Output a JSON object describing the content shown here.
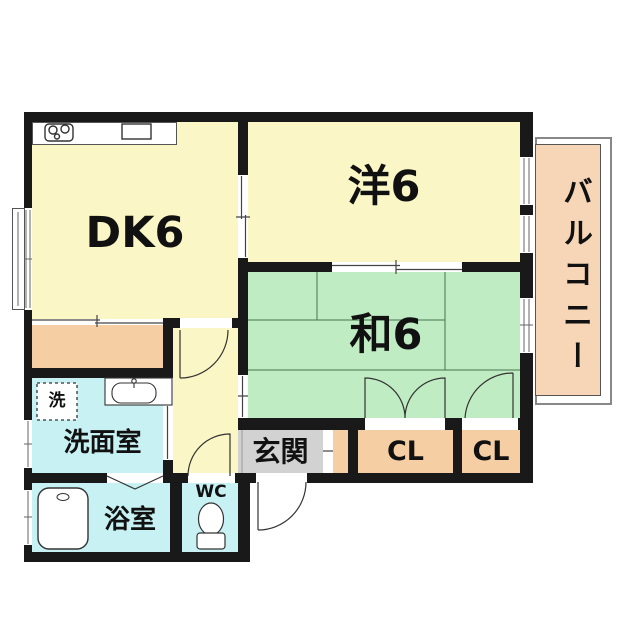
{
  "floorplan": {
    "type": "apartment-floor-plan",
    "rooms": {
      "dk": {
        "label": "DK6"
      },
      "western": {
        "label": "洋6"
      },
      "japanese": {
        "label": "和6"
      },
      "balcony": {
        "label": "バルコニー"
      },
      "entrance": {
        "label": "玄関"
      },
      "washroom": {
        "label": "洗面室"
      },
      "bathroom": {
        "label": "浴室"
      },
      "toilet": {
        "label": "WC"
      },
      "closet1": {
        "label": "CL"
      },
      "closet2": {
        "label": "CL"
      },
      "washer": {
        "label": "洗"
      }
    },
    "colors": {
      "wall": "#191919",
      "room_yellow": "#faf6c5",
      "tatami_green": "#c0ecc3",
      "closet_peach": "#f5cea4",
      "balcony_peach": "#f7d6b8",
      "wet_blue": "#c7f1f3",
      "entrance_gray": "#d2d2d2",
      "line": "#444444",
      "tatami_line": "#44744f"
    }
  }
}
